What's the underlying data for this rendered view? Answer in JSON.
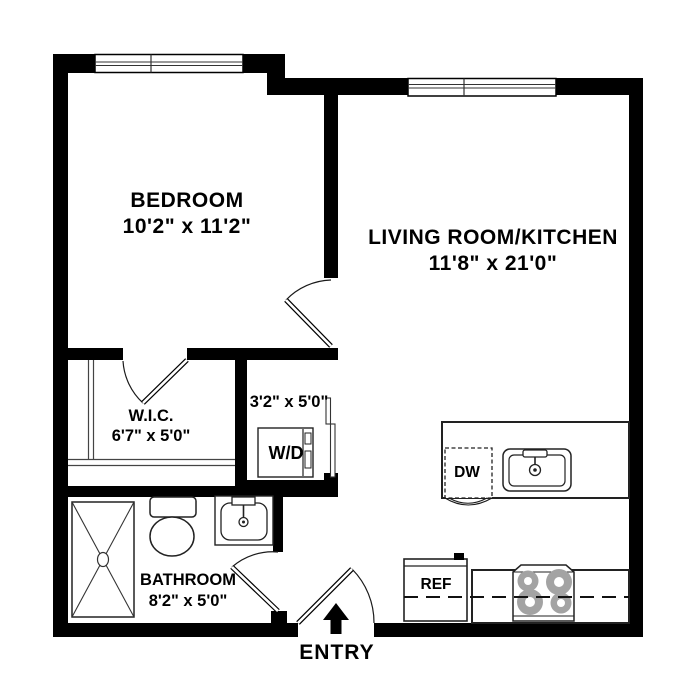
{
  "rooms": {
    "bedroom": {
      "label": "BEDROOM",
      "dims": "10'2\" x 11'2\""
    },
    "living": {
      "label": "LIVING ROOM/KITCHEN",
      "dims": "11'8\" x 21'0\""
    },
    "wic": {
      "label": "W.I.C.",
      "dims": "6'7\" x 5'0\""
    },
    "laundry": {
      "dims": "3'2\" x 5'0\""
    },
    "bathroom": {
      "label": "BATHROOM",
      "dims": "8'2\" x 5'0\""
    }
  },
  "appliances": {
    "washer_dryer": "W/D",
    "dishwasher": "DW",
    "refrigerator": "REF"
  },
  "labels": {
    "entry": "ENTRY"
  },
  "colors": {
    "wall": "#000000",
    "background": "#ffffff",
    "line": "#1a1a1a",
    "burner": "#a3a3a3"
  }
}
